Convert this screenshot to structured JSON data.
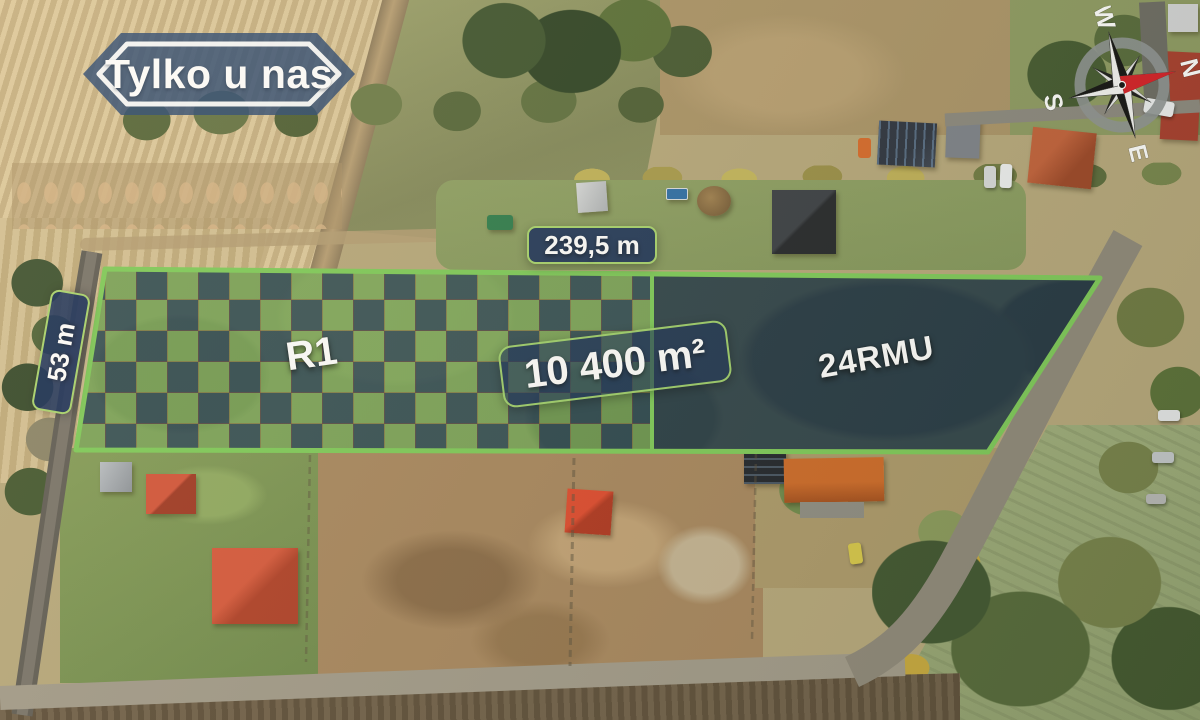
{
  "badge": {
    "label": "Tylko u nas"
  },
  "compass": {
    "letters": {
      "n": "N",
      "e": "E",
      "s": "S",
      "w": "W"
    },
    "needle_color": "#d61e26"
  },
  "plot": {
    "frontage_label": "239,5 m",
    "depth_label": "53 m",
    "area_label": "10 400 m²",
    "zone_labels": {
      "left": "R1",
      "right": "24RMU"
    },
    "outline_color": "#7ecb5a",
    "checker_overlay_color": "#142c56",
    "checker_green_color": "#96d25f",
    "solid_overlay_color": "#152646",
    "label_background": "#162c5a",
    "label_border": "#a8d46e",
    "badge_background": "#2c4a72"
  }
}
